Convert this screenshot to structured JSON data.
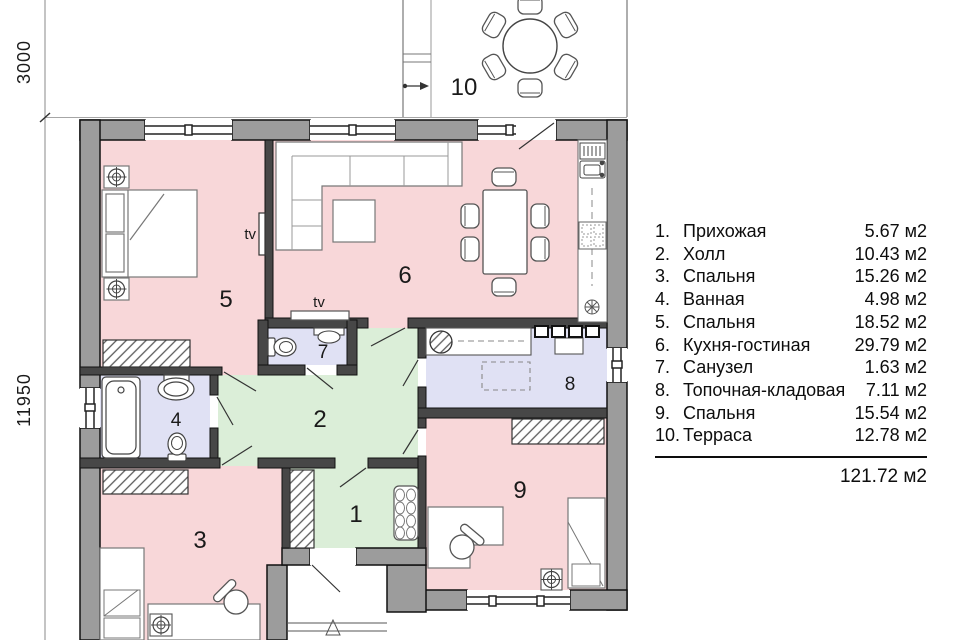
{
  "legend": {
    "items": [
      {
        "num": "1.",
        "label": "Прихожая",
        "area": "5.67 м2"
      },
      {
        "num": "2.",
        "label": "Холл",
        "area": "10.43 м2"
      },
      {
        "num": "3.",
        "label": "Спальня",
        "area": "15.26 м2"
      },
      {
        "num": "4.",
        "label": "Ванная",
        "area": "4.98 м2"
      },
      {
        "num": "5.",
        "label": "Спальня",
        "area": "18.52 м2"
      },
      {
        "num": "6.",
        "label": "Кухня-гостиная",
        "area": "29.79 м2"
      },
      {
        "num": "7.",
        "label": "Санузел",
        "area": "1.63 м2"
      },
      {
        "num": "8.",
        "label": "Топочная-кладовая",
        "area": "7.11 м2"
      },
      {
        "num": "9.",
        "label": "Спальня",
        "area": "15.54 м2"
      },
      {
        "num": "10.",
        "label": "Терраса",
        "area": "12.78 м2"
      }
    ],
    "total": "121.72 м2"
  },
  "plan": {
    "dimensions": {
      "top": "3000",
      "side": "11950"
    },
    "rooms": {
      "r1": "1",
      "r2": "2",
      "r3": "3",
      "r4": "4",
      "r5": "5",
      "r6": "6",
      "r7": "7",
      "r8": "8",
      "r9": "9",
      "r10": "10"
    },
    "tv_wall": "tv",
    "tv_stand": "tv"
  },
  "colors": {
    "room_pink": "#f8d7d9",
    "room_green": "#dbeed8",
    "room_lavender": "#e0e1f4",
    "wall_outer": "#9c9c9c",
    "wall_inner": "#474747"
  }
}
